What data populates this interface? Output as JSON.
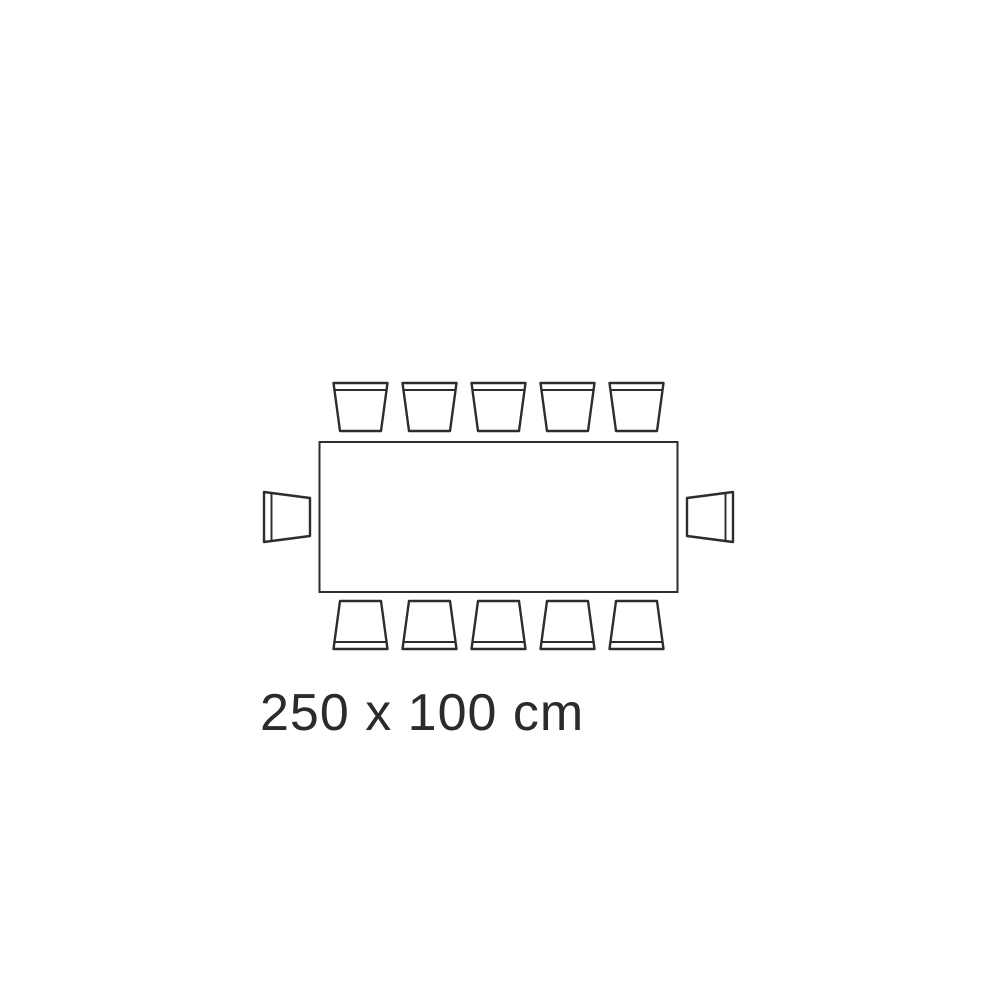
{
  "page": {
    "background_color": "#ffffff"
  },
  "diagram": {
    "label": "250 x 100 cm",
    "table": {
      "width_cm": 250,
      "depth_cm": 100,
      "shape": "rectangle"
    },
    "seats": {
      "top": 5,
      "bottom": 5,
      "left": 1,
      "right": 1,
      "total": 12
    },
    "colors": {
      "line": "#2d2d2d",
      "label_text": "#2b2b2b",
      "table_fill": "#ffffff",
      "chair_fill": "#ffffff"
    }
  }
}
